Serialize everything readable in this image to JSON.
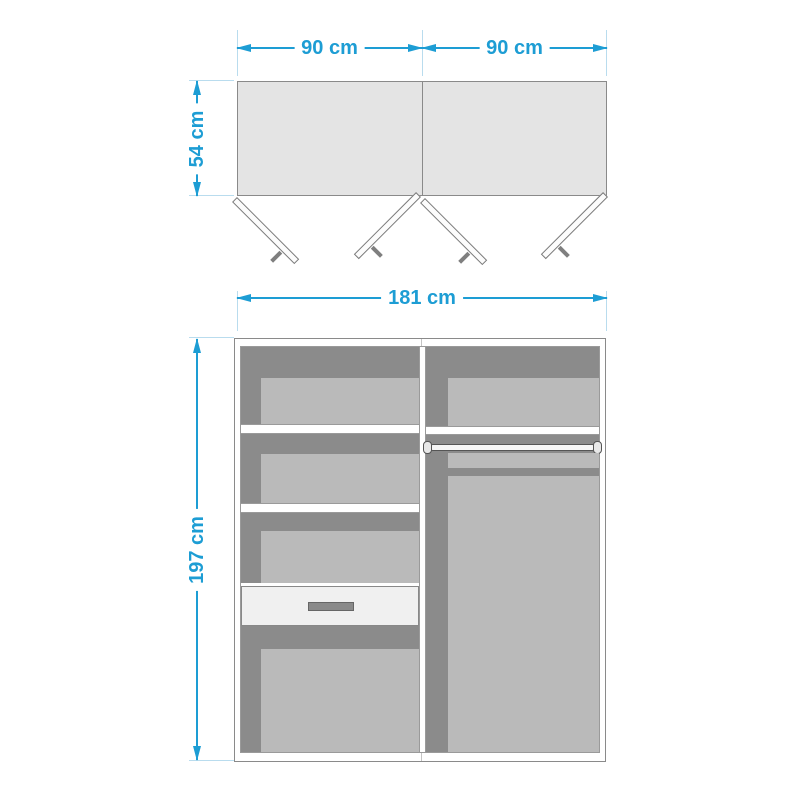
{
  "top_view": {
    "dim_width_left": "90 cm",
    "dim_width_right": "90 cm",
    "dim_depth": "54 cm"
  },
  "front_view": {
    "dim_width": "181 cm",
    "dim_height": "197 cm"
  },
  "colors": {
    "dimension_accent": "#1d9dd4",
    "extension_line": "#b9dcee",
    "panel_top_fill": "#e4e4e4",
    "interior_dark": "#8b8b8b",
    "interior_light": "#bababa",
    "outline_gray": "#8a8a8a",
    "handle_gray": "#7f7f7f"
  }
}
